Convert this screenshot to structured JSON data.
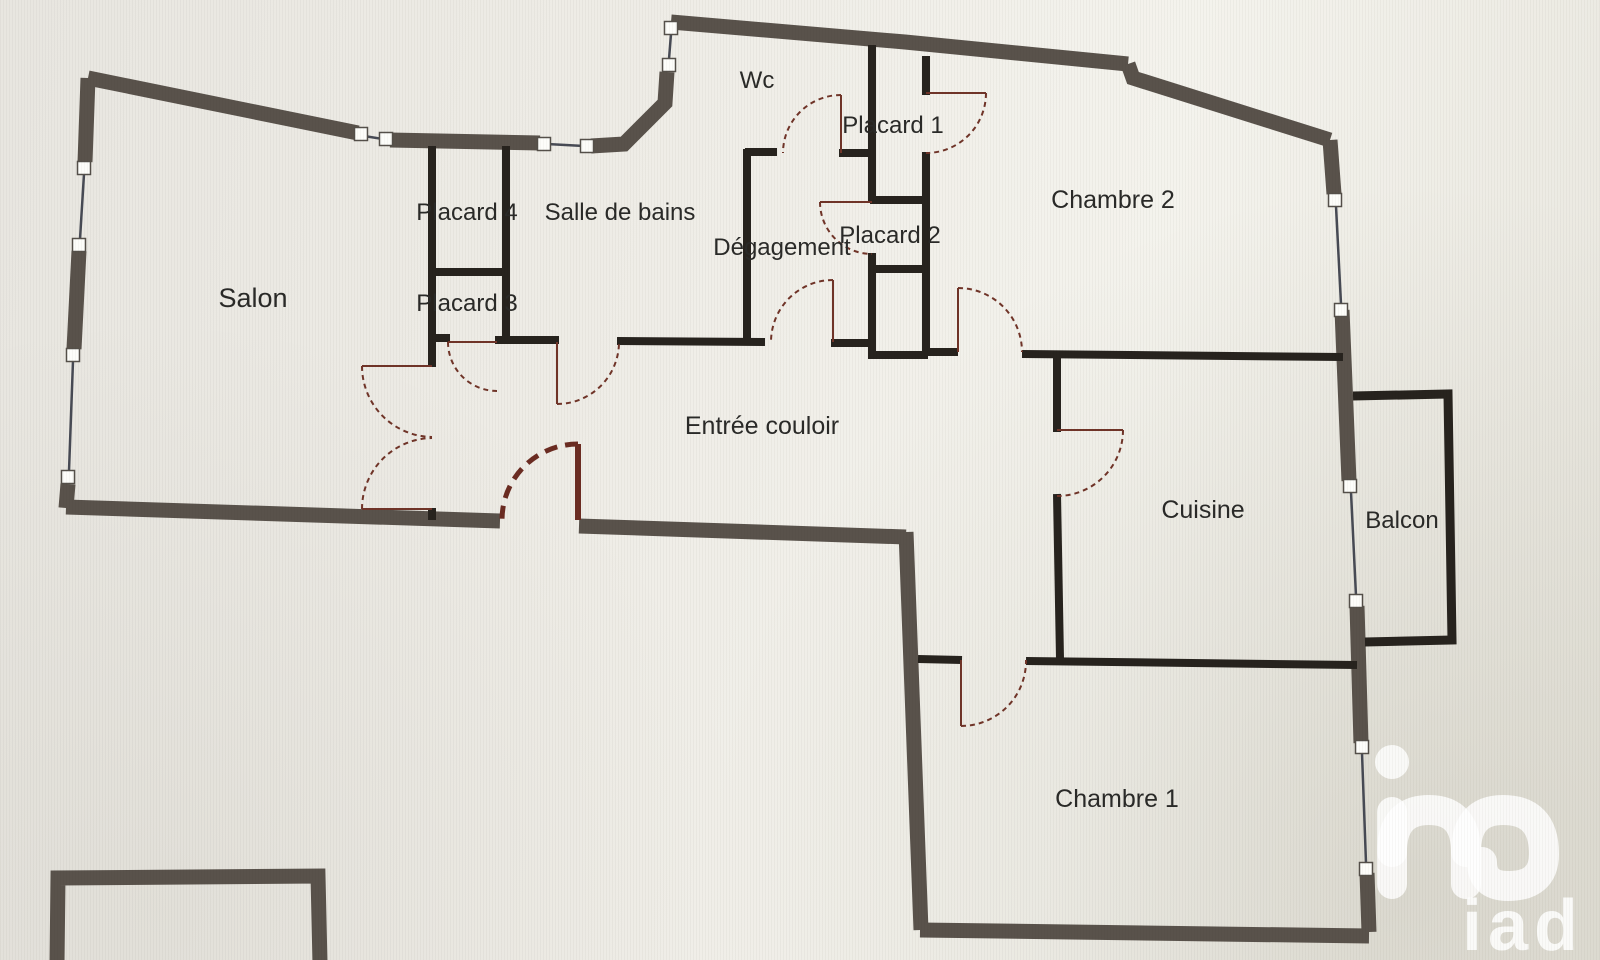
{
  "plan": {
    "type": "apartment-floor-plan",
    "rooms": [
      {
        "id": "salon",
        "label": "Salon"
      },
      {
        "id": "placard-4",
        "label": "Placard 4"
      },
      {
        "id": "salle-de-bains",
        "label": "Salle de bains"
      },
      {
        "id": "wc",
        "label": "Wc"
      },
      {
        "id": "placard-1",
        "label": "Placard 1"
      },
      {
        "id": "degagement",
        "label": "Dégagement"
      },
      {
        "id": "placard-2",
        "label": "Placard 2"
      },
      {
        "id": "placard-3",
        "label": "Placard 3"
      },
      {
        "id": "chambre-2",
        "label": "Chambre 2"
      },
      {
        "id": "entree-couloir",
        "label": "Entrée couloir"
      },
      {
        "id": "cuisine",
        "label": "Cuisine"
      },
      {
        "id": "balcon",
        "label": "Balcon"
      },
      {
        "id": "chambre-1",
        "label": "Chambre 1"
      }
    ]
  },
  "watermark": {
    "brand": "iad"
  },
  "colors": {
    "exterior_wall": "#59524b",
    "interior_wall": "#27231e",
    "door_arc": "#703428",
    "entrance_door": "#6b2c22",
    "window_line": "#474a54",
    "background": "#edebe4",
    "label_text": "#2a2a28",
    "watermark": "#ffffff"
  }
}
